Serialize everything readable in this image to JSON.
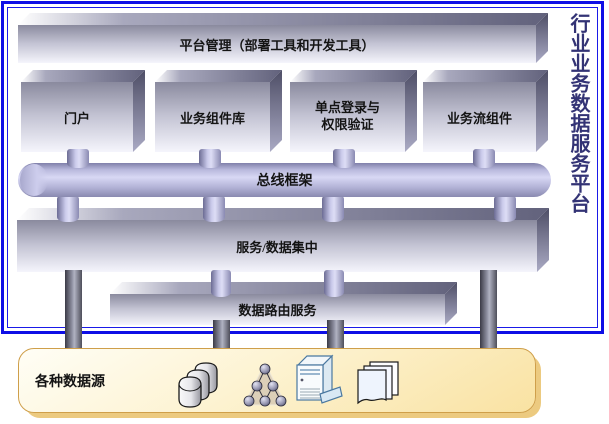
{
  "frame": {
    "border_color": "#0E0EE6"
  },
  "side_title": {
    "text": "行业业务数据服务平台",
    "color": "#333375"
  },
  "platform_box": {
    "label": "平台管理（部署工具和开发工具）"
  },
  "modules": [
    {
      "label": "门户"
    },
    {
      "label": "业务组件库"
    },
    {
      "label": "单点登录与\n权限验证"
    },
    {
      "label": "业务流组件"
    }
  ],
  "bus": {
    "label": "总线框架"
  },
  "service_box": {
    "label": "服务/数据集中"
  },
  "routing_box": {
    "label": "数据路由服务"
  },
  "datasource_panel": {
    "label": "各种数据源",
    "background": "#F9E2A2",
    "border_color": "#CF9F4A",
    "icons": [
      "database-stack-icon",
      "node-pyramid-icon",
      "pc-tower-icon",
      "documents-icon"
    ]
  }
}
